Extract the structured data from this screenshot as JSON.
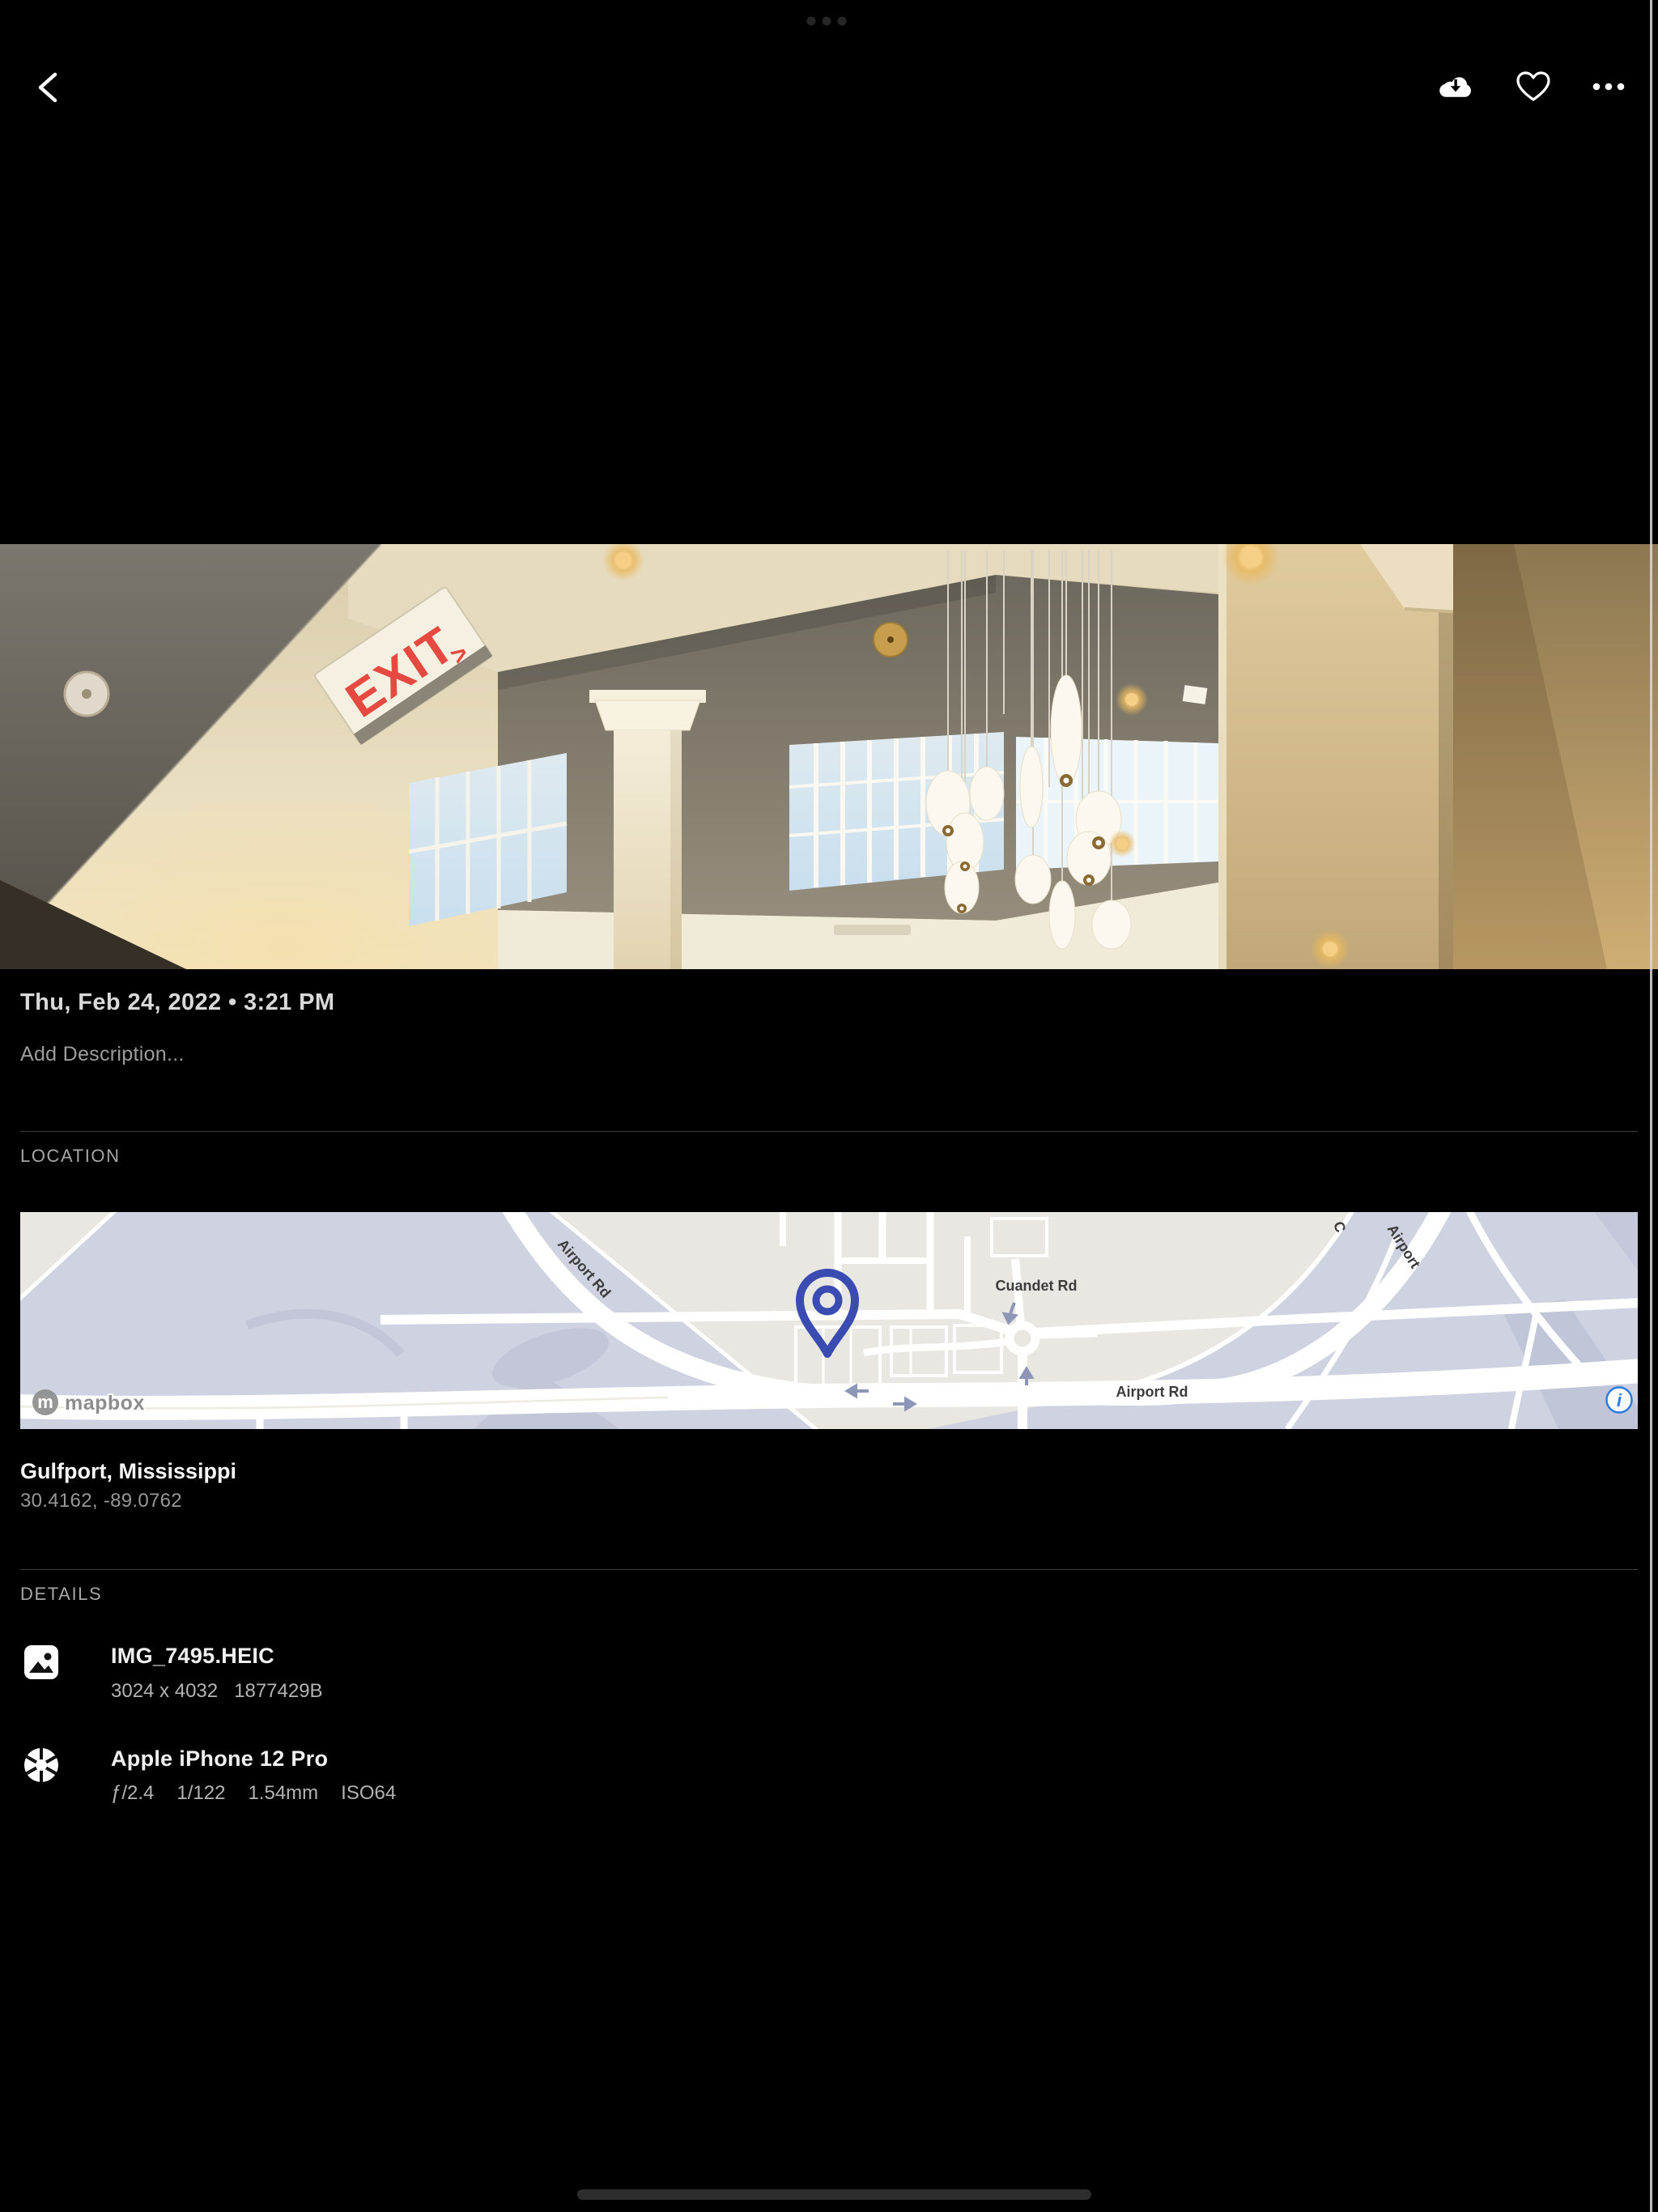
{
  "photo": {
    "exit_text": "EXIT",
    "exit_arrow": ">"
  },
  "meta": {
    "datetime": "Thu, Feb 24, 2022 • 3:21 PM",
    "description_placeholder": "Add Description..."
  },
  "location": {
    "label": "LOCATION",
    "place": "Gulfport, Mississippi",
    "coordinates": "30.4162, -89.0762",
    "map": {
      "road_labels": {
        "diagonal": "Airport Rd",
        "cuandet": "Cuandet Rd",
        "horizontal": "Airport Rd",
        "partial_top_right": "Airport",
        "partial_street": "C"
      },
      "attribution": "mapbox",
      "attribution_mark": "m",
      "info_glyph": "i"
    }
  },
  "details": {
    "label": "DETAILS",
    "rows": [
      {
        "icon": "image-icon",
        "title": "IMG_7495.HEIC",
        "subtitle": [
          "3024 x 4032",
          "1877429B"
        ]
      },
      {
        "icon": "camera-icon",
        "title": "Apple iPhone 12 Pro",
        "subtitle": [
          "ƒ/2.4",
          "1/122",
          "1.54mm",
          "ISO64"
        ]
      }
    ]
  },
  "colors": {
    "pin": "#3a4bb1",
    "info_icon": "#2b7ce0",
    "map_land": "#e9e7e1",
    "map_water": "#cfd3e1",
    "exit_red": "#e6493f"
  }
}
